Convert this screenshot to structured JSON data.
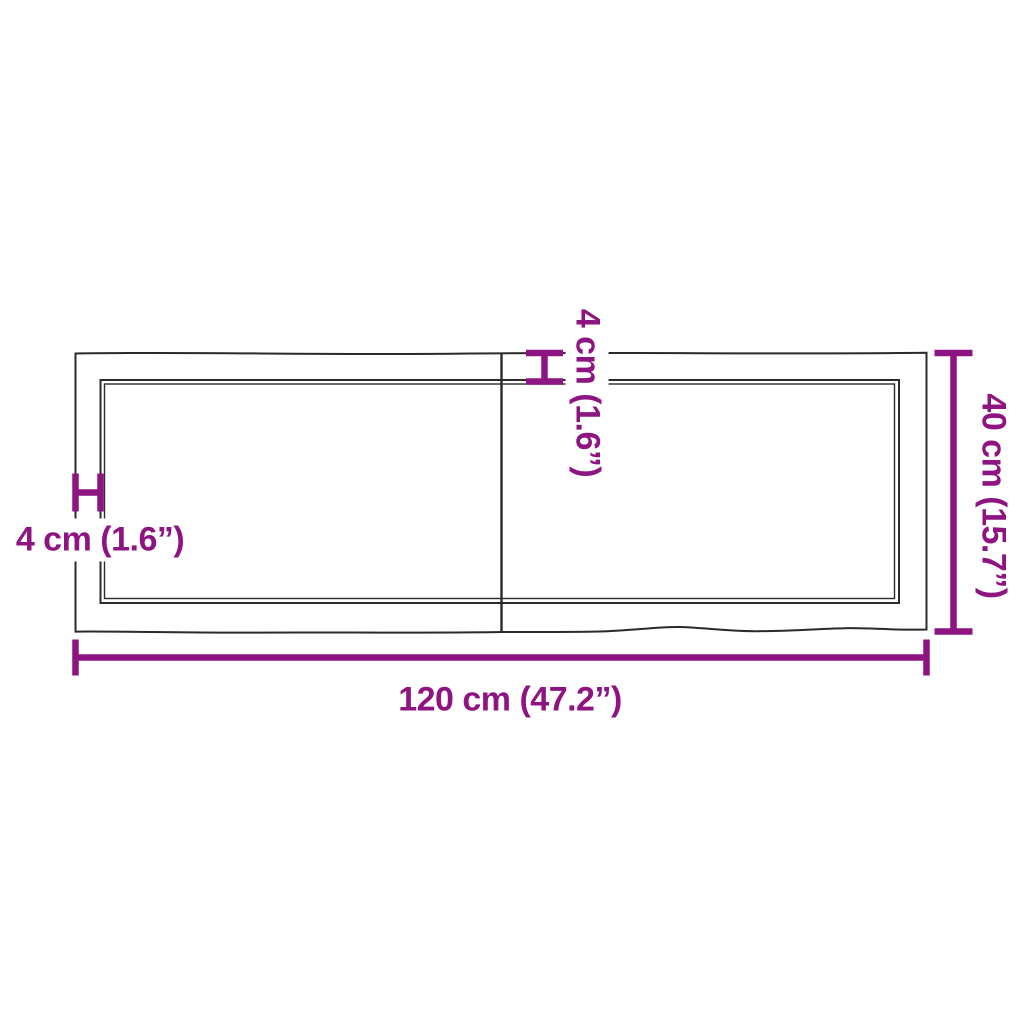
{
  "page": {
    "description": "Product dimension diagram of a rectangular panel (top view) with a center seam and live edges"
  },
  "colors": {
    "accent": "#8E1581",
    "line": "#2b2b2b",
    "background": "#ffffff"
  },
  "diagram": {
    "dimensions": {
      "width": {
        "label": "120 cm (47.2”)",
        "value_cm": 120,
        "value_in": 47.2,
        "position": "bottom"
      },
      "depth": {
        "label": "40 cm (15.7”)",
        "value_cm": 40,
        "value_in": 15.7,
        "position": "right"
      },
      "left_edge_inset": {
        "label": "4 cm (1.6”)",
        "value_cm": 4,
        "value_in": 1.6,
        "position": "left"
      },
      "top_edge_inset": {
        "label": "4 cm (1.6”)",
        "value_cm": 4,
        "value_in": 1.6,
        "position": "top"
      }
    }
  }
}
